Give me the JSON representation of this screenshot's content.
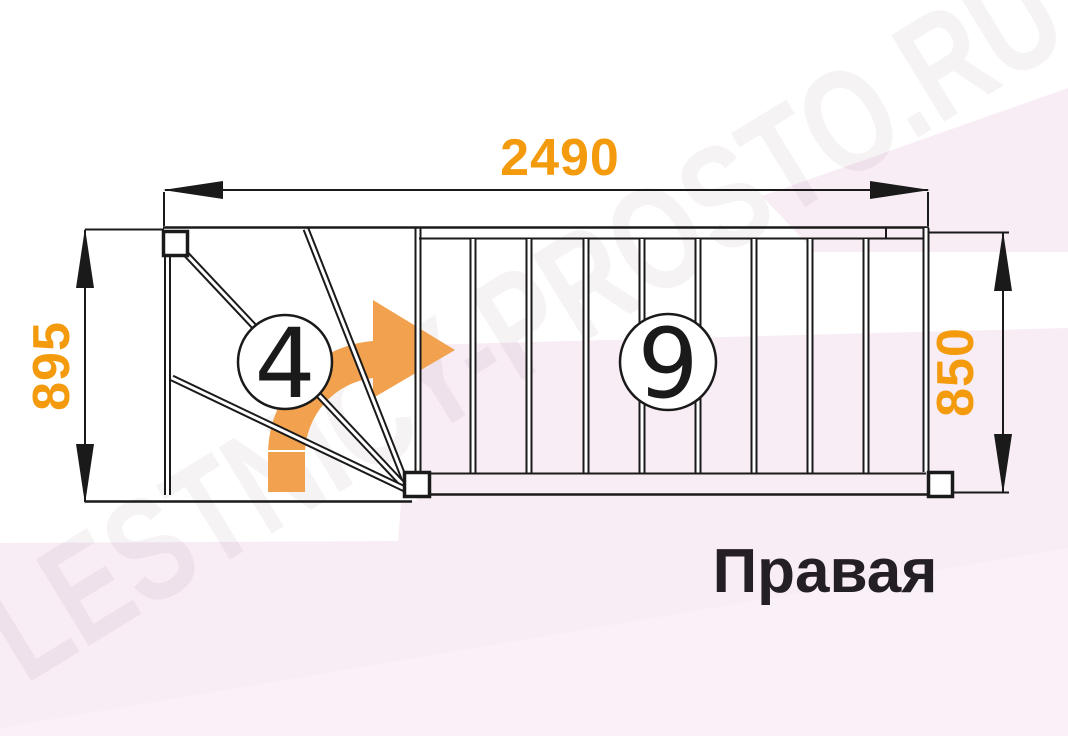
{
  "diagram": {
    "title": "Правая",
    "watermark": "LESTNICY-PROSTO.RU",
    "dimensions": {
      "total_length": "2490",
      "winder_width": "895",
      "flight_width": "850"
    },
    "steps": {
      "winder_count": "4",
      "straight_count": "9"
    },
    "colors": {
      "dimension_orange": "#f39a0d",
      "arrow_orange": "#f2a14e",
      "line_black": "#1a1a1a",
      "background_pink": "#f8ecf5",
      "background_pink_light": "#faf1f8"
    }
  }
}
